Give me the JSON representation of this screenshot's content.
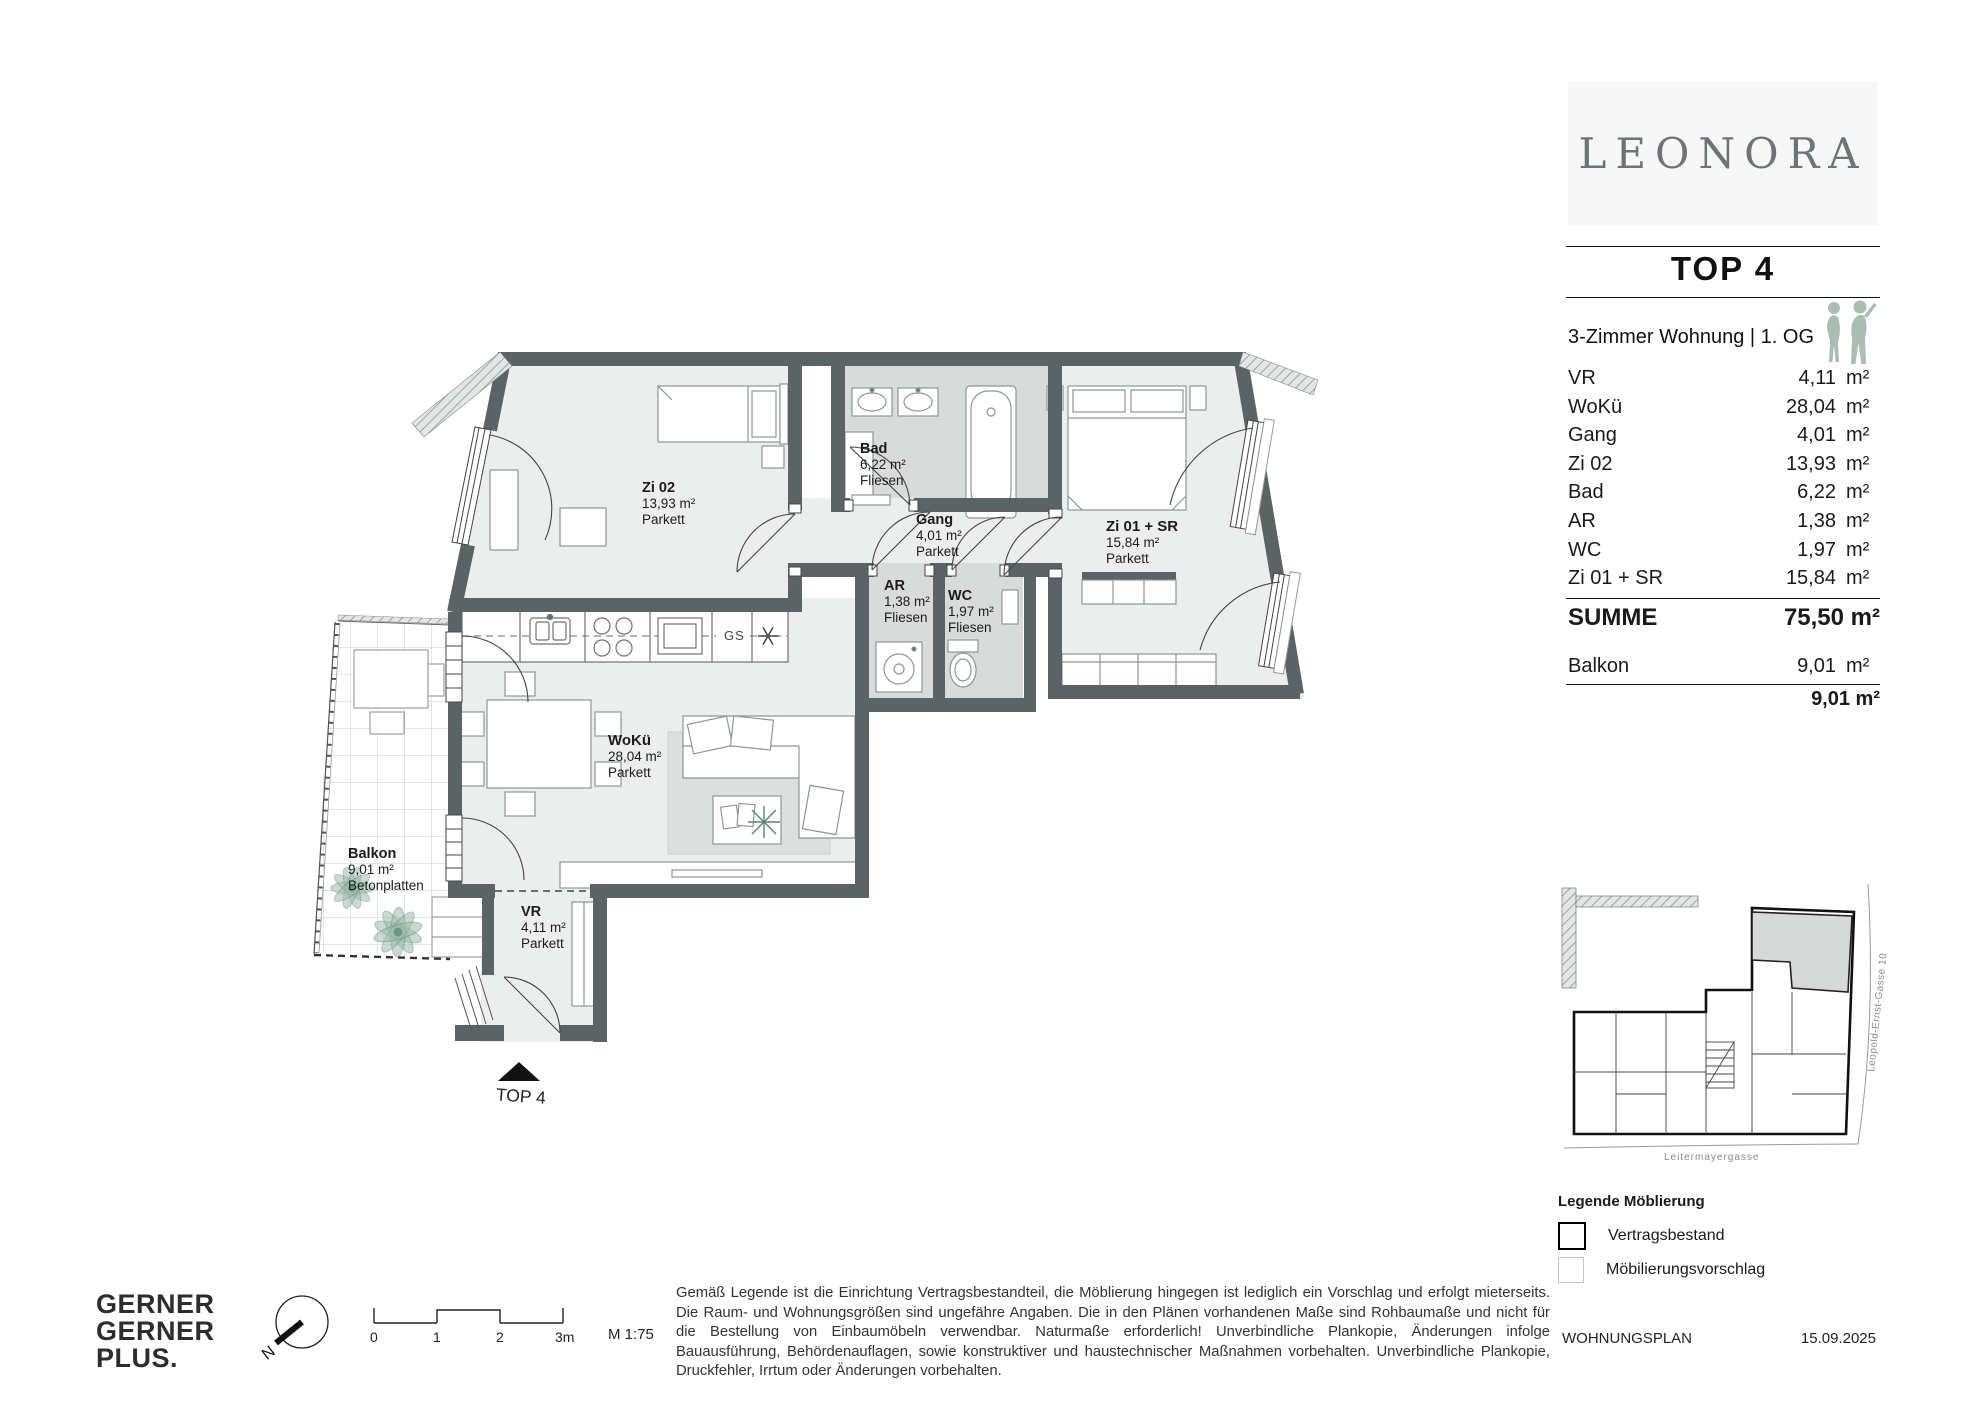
{
  "branding": {
    "project_name": "LEONORA",
    "unit_title": "TOP 4"
  },
  "unit": {
    "subtitle": "3-Zimmer Wohnung | 1. OG",
    "rooms": [
      {
        "label": "VR",
        "value": "4,11",
        "unit": "m²"
      },
      {
        "label": "WoKü",
        "value": "28,04",
        "unit": "m²"
      },
      {
        "label": "Gang",
        "value": "4,01",
        "unit": "m²"
      },
      {
        "label": "Zi 02",
        "value": "13,93",
        "unit": "m²"
      },
      {
        "label": "Bad",
        "value": "6,22",
        "unit": "m²"
      },
      {
        "label": "AR",
        "value": "1,38",
        "unit": "m²"
      },
      {
        "label": "WC",
        "value": "1,97",
        "unit": "m²"
      },
      {
        "label": "Zi 01 + SR",
        "value": "15,84",
        "unit": "m²"
      }
    ],
    "total_label": "SUMME",
    "total_value": "75,50 m²",
    "balcony_label": "Balkon",
    "balcony_value": "9,01",
    "balcony_unit": "m²",
    "balcony_total": "9,01 m²"
  },
  "plan": {
    "rooms": {
      "zi02": {
        "name": "Zi 02",
        "area": "13,93 m²",
        "floor": "Parkett"
      },
      "bad": {
        "name": "Bad",
        "area": "6,22 m²",
        "floor": "Fliesen"
      },
      "gang": {
        "name": "Gang",
        "area": "4,01 m²",
        "floor": "Parkett"
      },
      "ar": {
        "name": "AR",
        "area": "1,38 m²",
        "floor": "Fliesen"
      },
      "wc": {
        "name": "WC",
        "area": "1,97 m²",
        "floor": "Fliesen"
      },
      "zi01": {
        "name": "Zi 01 + SR",
        "area": "15,84 m²",
        "floor": "Parkett"
      },
      "woku": {
        "name": "WoKü",
        "area": "28,04 m²",
        "floor": "Parkett"
      },
      "balkon": {
        "name": "Balkon",
        "area": "9,01 m²",
        "floor": "Betonplatten"
      },
      "vr": {
        "name": "VR",
        "area": "4,11 m²",
        "floor": "Parkett"
      }
    },
    "kitchen_dishwasher_label": "GS",
    "entrance_label": "TOP 4"
  },
  "keyplan": {
    "street_bottom": "Leitermayergasse",
    "street_right": "Leopold-Ernst-Gasse 10"
  },
  "legend": {
    "title": "Legende Möblierung",
    "items": [
      {
        "label": "Vertragsbestand"
      },
      {
        "label": "Möbilierungsvorschlag"
      }
    ]
  },
  "footer": {
    "company_lines": [
      "GERNER",
      "GERNER",
      "PLUS."
    ],
    "north_label": "N",
    "scale_ticks": [
      "0",
      "1",
      "2",
      "3m"
    ],
    "scale_label": "M 1:75",
    "disclaimer": "Gemäß Legende ist die Einrichtung Vertragsbestandteil, die Möblierung hingegen ist lediglich ein Vorschlag und erfolgt mieterseits. Die Raum- und Wohnungsgrößen sind ungefähre Angaben. Die in den Plänen vorhandenen Maße sind Rohbaumaße und nicht für die Bestellung von Einbaumöbeln verwendbar. Naturmaße erforderlich! Unverbindliche Plankopie, Änderungen infolge Bauausführung, Behördenauflagen, sowie konstruktiver und haustechnischer Maßnahmen vorbehalten. Unverbindliche Plankopie, Druckfehler, Irrtum oder Änderungen vorbehalten.",
    "doc_label": "WOHNUNGSPLAN",
    "date": "15.09.2025"
  },
  "colors": {
    "wall": "#5b6365",
    "room_floor": "#eceded",
    "wet_floor": "#d8dbda",
    "rug": "#dcdfde",
    "keyplan_highlight": "#d6d9d7",
    "silhouette": "#a9bdb3"
  }
}
